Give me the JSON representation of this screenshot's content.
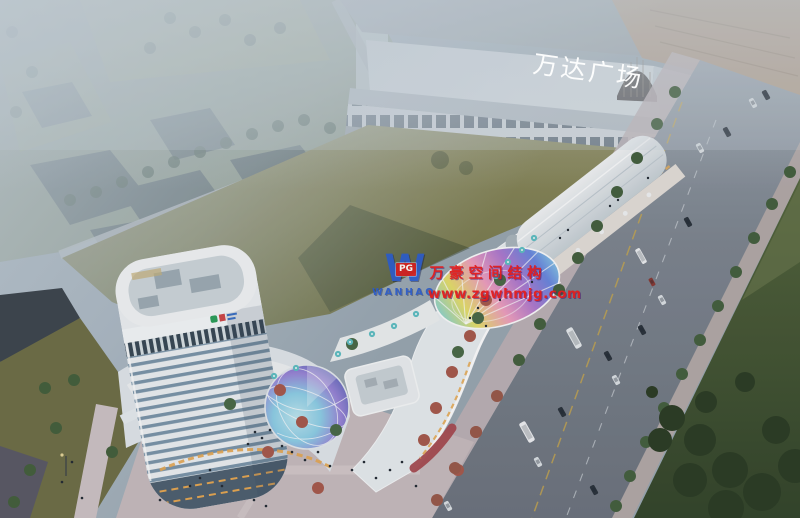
{
  "image": {
    "width": 800,
    "height": 518,
    "kind": "aerial architectural rendering at dusk"
  },
  "mall": {
    "sign": "万达广场",
    "sign_color": "#ffffff"
  },
  "watermark": {
    "logo_letter": "W",
    "logo_badge": "PG",
    "logo_name": "WANHAO",
    "line1": "万豪空间结构",
    "line2": "www.zgwhmjg.com",
    "text_color": "#e21d1d",
    "logo_blue": "#2b5bc8",
    "badge_red": "#d42020"
  },
  "palette": {
    "haze": "#c3ced6",
    "field_green": "#85845a",
    "field_shadow": "#3f4c30",
    "road_asphalt": "#767e88",
    "sidewalk_pink": "#c3b4b6",
    "lawn_dark": "#41532f",
    "tree_green": "#3f5a3c",
    "tree_red": "#a85a4c",
    "building_white": "#eceff1",
    "tower_glass": "#7c96aa",
    "mall_gray": "#dfe5e8",
    "construction_tan": "#b59a80",
    "accent_red_wall": "#a84a50",
    "amber_glow": "#e8a851",
    "umbrella_teal": "#5fc0c4",
    "dome_colors": [
      "#bfe8f0",
      "#8fd0e8",
      "#9a86d8",
      "#5a66b8",
      "#3a5aa0"
    ],
    "canopy_colors": [
      "#7fd4e0",
      "#e8e06a",
      "#f0a0c0",
      "#b07ad0",
      "#6a88e0"
    ]
  }
}
